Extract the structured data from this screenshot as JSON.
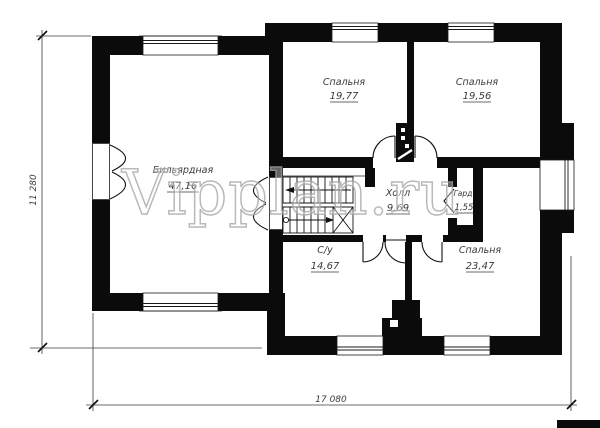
{
  "watermark": {
    "text": "Vipplan.ru"
  },
  "dimensions": {
    "vertical": "11 280",
    "horizontal": "17 080"
  },
  "rooms": [
    {
      "id": "billiard",
      "name": "Бильярдная",
      "area": "47,16"
    },
    {
      "id": "bedroom-1",
      "name": "Спальня",
      "area": "19,77"
    },
    {
      "id": "bedroom-2",
      "name": "Спальня",
      "area": "19,56"
    },
    {
      "id": "hall",
      "name": "Холл",
      "area": "9,69"
    },
    {
      "id": "wardrobe",
      "name": "Гард",
      "area": "1,55"
    },
    {
      "id": "bathroom",
      "name": "С/у",
      "area": "14,67"
    },
    {
      "id": "bedroom-3",
      "name": "Спальня",
      "area": "23,47"
    }
  ]
}
